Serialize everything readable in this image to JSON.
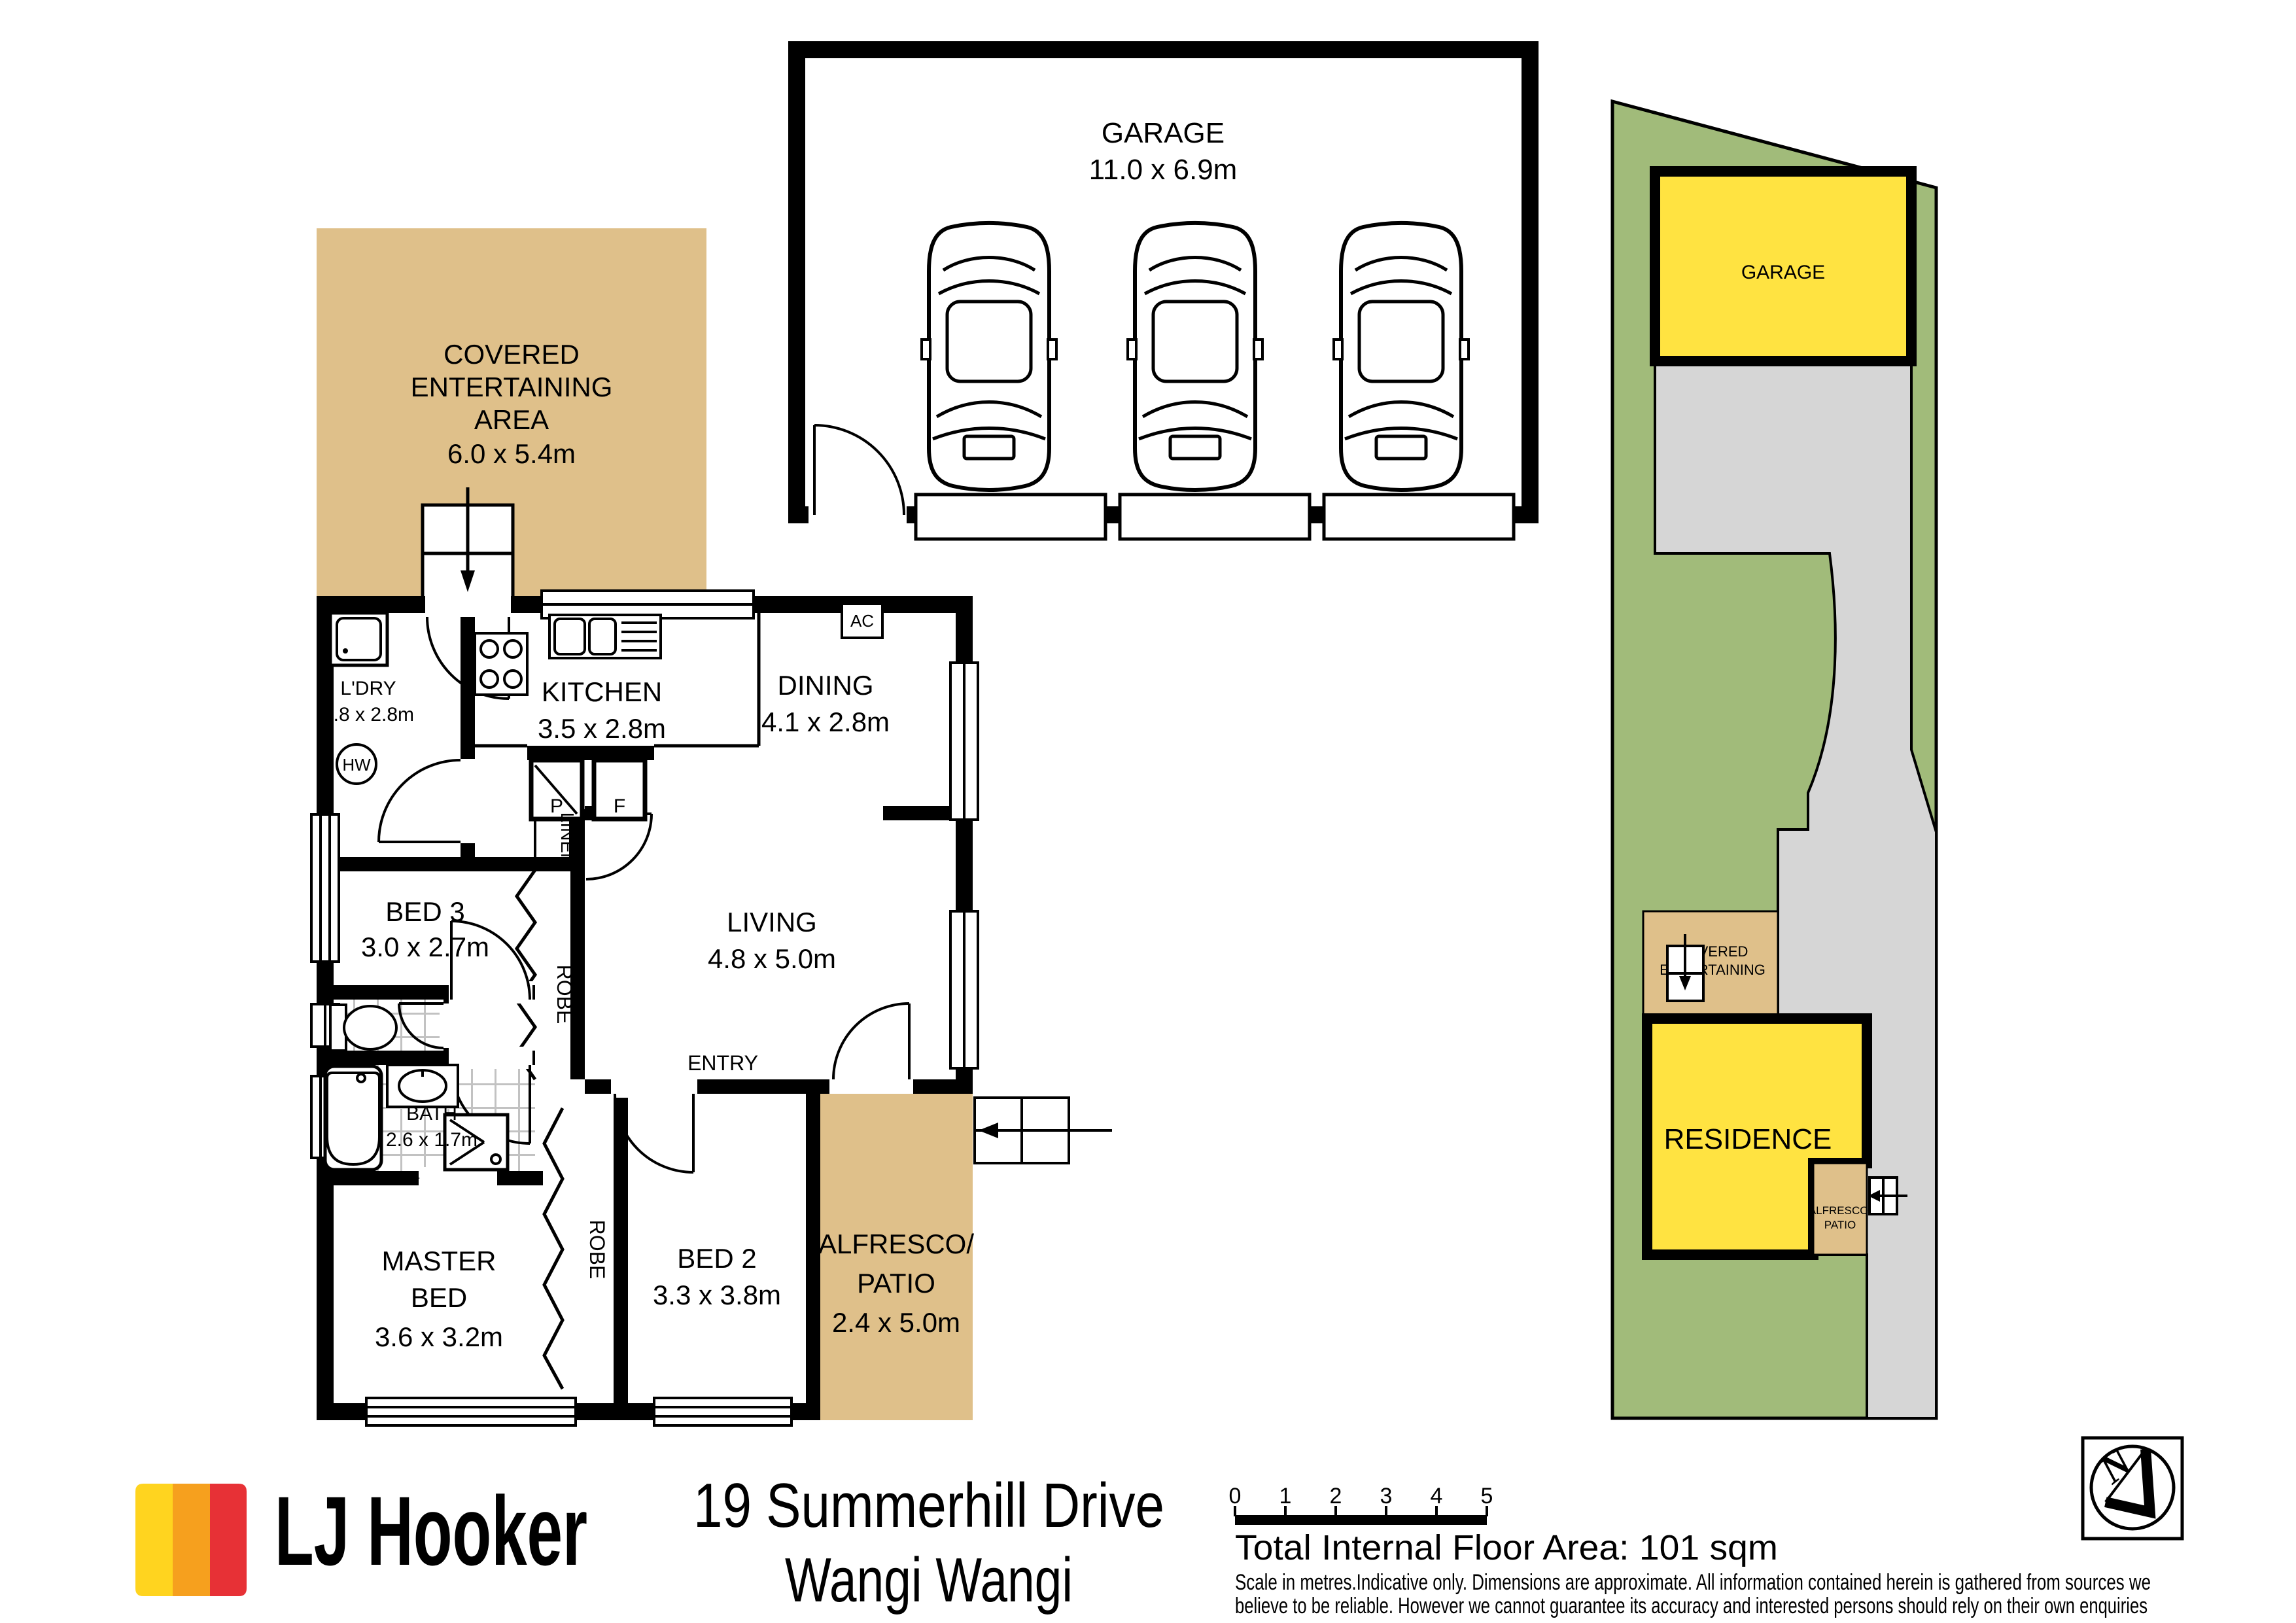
{
  "colors": {
    "tan": "#DFC08A",
    "site_green": "#A1BB7A",
    "driveway_gray": "#D6D6D6",
    "highlight_yellow": "#FFE341",
    "brand_yellow": "#FFD41F",
    "brand_orange": "#F6A01E",
    "brand_red": "#E73136"
  },
  "floor_plan": {
    "garage": {
      "name": "GARAGE",
      "dims": "11.0 x 6.9m"
    },
    "covered_area": {
      "line1": "COVERED",
      "line2": "ENTERTAINING",
      "line3": "AREA",
      "dims": "6.0 x 5.4m"
    },
    "laundry": {
      "name": "L'DRY",
      "dims": "1.8 x 2.8m"
    },
    "kitchen": {
      "name": "KITCHEN",
      "dims": "3.5 x 2.8m"
    },
    "dining": {
      "name": "DINING",
      "dims": "4.1 x 2.8m"
    },
    "living": {
      "name": "LIVING",
      "dims": "4.8 x 5.0m"
    },
    "bed3": {
      "name": "BED 3",
      "dims": "3.0 x 2.7m"
    },
    "bed2": {
      "name": "BED 2",
      "dims": "3.3 x 3.8m"
    },
    "master": {
      "line1": "MASTER",
      "line2": "BED",
      "dims": "3.6 x 3.2m"
    },
    "bath": {
      "name": "BATH",
      "dims": "2.6 x 1.7m"
    },
    "alfresco": {
      "line1": "ALFRESCO/",
      "line2": "PATIO",
      "dims": "2.4 x 5.0m"
    },
    "entry": "ENTRY",
    "linen": "LINEN",
    "robe": "ROBE",
    "hw": "HW",
    "ac": "AC",
    "pantry": "P",
    "fridge": "F"
  },
  "site_plan": {
    "garage": "GARAGE",
    "covered": {
      "line1": "COVERED",
      "line2": "ENTERTAINING"
    },
    "residence": "RESIDENCE",
    "alfresco": {
      "line1": "ALFRESCO/",
      "line2": "PATIO"
    }
  },
  "footer": {
    "brand": "LJ Hooker",
    "address_line1": "19 Summerhill Drive",
    "address_line2": "Wangi Wangi",
    "scale_ticks": [
      "0",
      "1",
      "2",
      "3",
      "4",
      "5"
    ],
    "total_area": "Total Internal Floor Area: 101 sqm",
    "disclaimer_line1": "Scale in metres.Indicative only. Dimensions are approximate. All information contained herein is gathered from sources we",
    "disclaimer_line2": "believe to be reliable. However we cannot guarantee its accuracy and interested persons should rely on their own enquiries",
    "compass_letter": "N"
  }
}
